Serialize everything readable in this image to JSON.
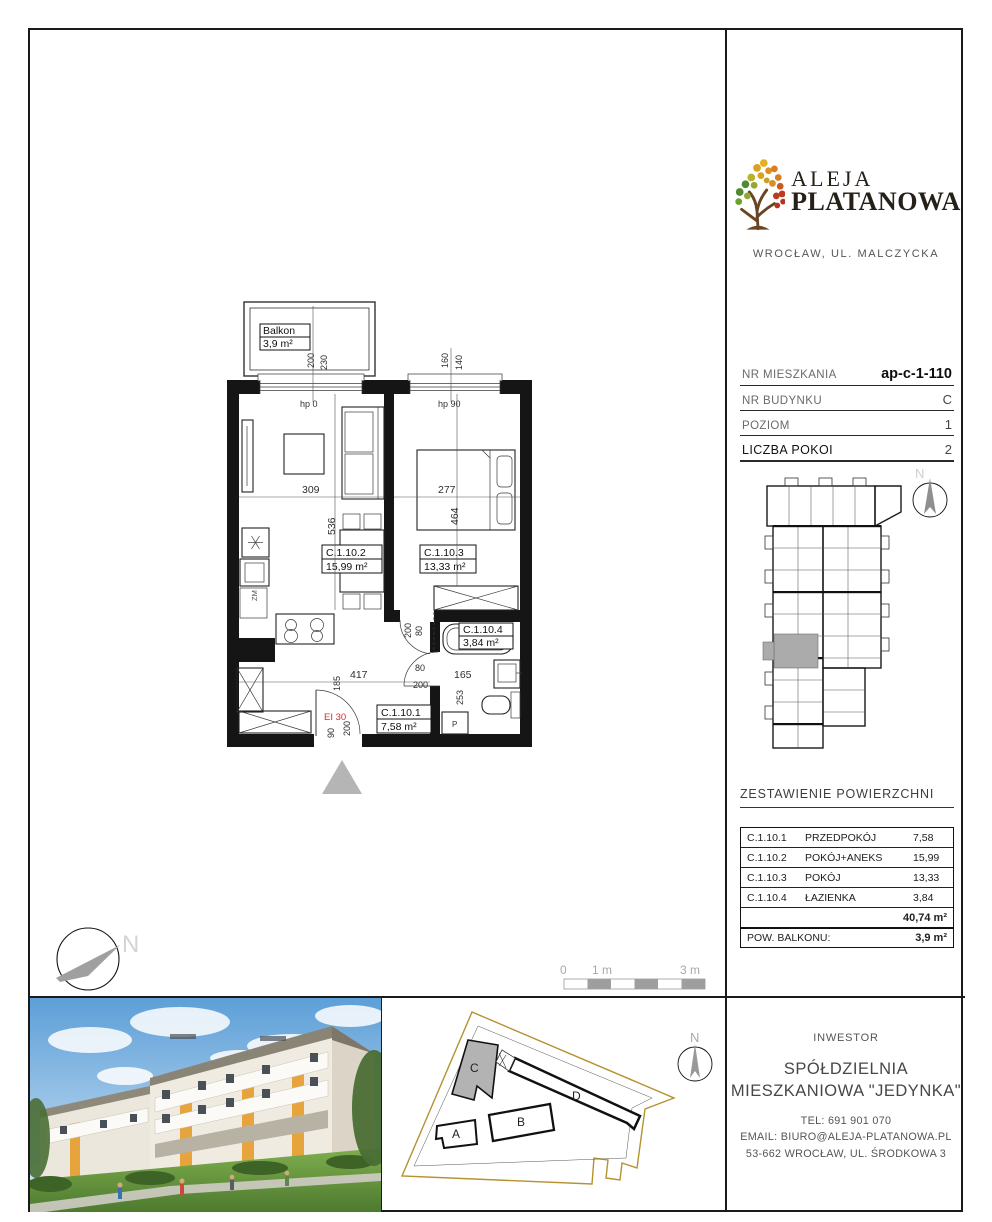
{
  "logo": {
    "title1": "ALEJA",
    "title2": "PLATANOWA",
    "subtitle": "WROCŁAW, UL. MALCZYCKA"
  },
  "info": {
    "rows": [
      {
        "label": "NR MIESZKANIA",
        "value": "ap-c-1-110"
      },
      {
        "label": "NR BUDYNKU",
        "value": "C"
      },
      {
        "label": "POZIOM",
        "value": "1"
      },
      {
        "label": "LICZBA POKOI",
        "value": "2"
      }
    ]
  },
  "plan": {
    "balcony": {
      "name": "Balkon",
      "area": "3,9 m²"
    },
    "rooms": {
      "r1": {
        "id": "C.1.10.1",
        "area": "7,58 m²"
      },
      "r2": {
        "id": "C.1.10.2",
        "area": "15,99 m²"
      },
      "r3": {
        "id": "C.1.10.3",
        "area": "13,33 m²"
      },
      "r4": {
        "id": "C.1.10.4",
        "area": "3,84 m²"
      }
    },
    "windows": {
      "w1a": "200",
      "w1b": "230",
      "w1hp": "hp 0",
      "w2a": "160",
      "w2b": "140",
      "w2hp": "hp 90"
    },
    "dims": {
      "a309": "309",
      "a536": "536",
      "a277": "277",
      "a464": "464",
      "a417": "417",
      "a80": "80",
      "a200": "200",
      "a165": "165",
      "a253": "253",
      "a185": "185",
      "a90": "90",
      "b200": "200",
      "b80": "80",
      "c200": "200"
    },
    "fire_rating": "EI 30",
    "washer": "P",
    "dishwasher": "ZM"
  },
  "scalebar": {
    "l0": "0",
    "l1": "1 m",
    "l3": "3 m"
  },
  "north_letter": "N",
  "areas": {
    "title": "ZESTAWIENIE POWIERZCHNI",
    "rows": [
      [
        "C.1.10.1",
        "PRZEDPOKÓJ",
        "7,58"
      ],
      [
        "C.1.10.2",
        "POKÓJ+ANEKS",
        "15,99"
      ],
      [
        "C.1.10.3",
        "POKÓJ",
        "13,33"
      ],
      [
        "C.1.10.4",
        "ŁAZIENKA",
        "3,84"
      ]
    ],
    "total": "40,74 m²",
    "balcony_label": "POW. BALKONU:",
    "balcony_value": "3,9 m²"
  },
  "sitemap": {
    "a": "A",
    "b": "B",
    "c": "C",
    "d": "D"
  },
  "investor": {
    "heading": "INWESTOR",
    "line1": "SPÓŁDZIELNIA",
    "line2": "MIESZKANIOWA \"JEDYNKA\"",
    "tel": "TEL:  691 901 070",
    "email": "EMAIL: BIURO@ALEJA-PLATANOWA.PL",
    "address": "53-662 WROCŁAW, UL. ŚRODKOWA 3"
  }
}
